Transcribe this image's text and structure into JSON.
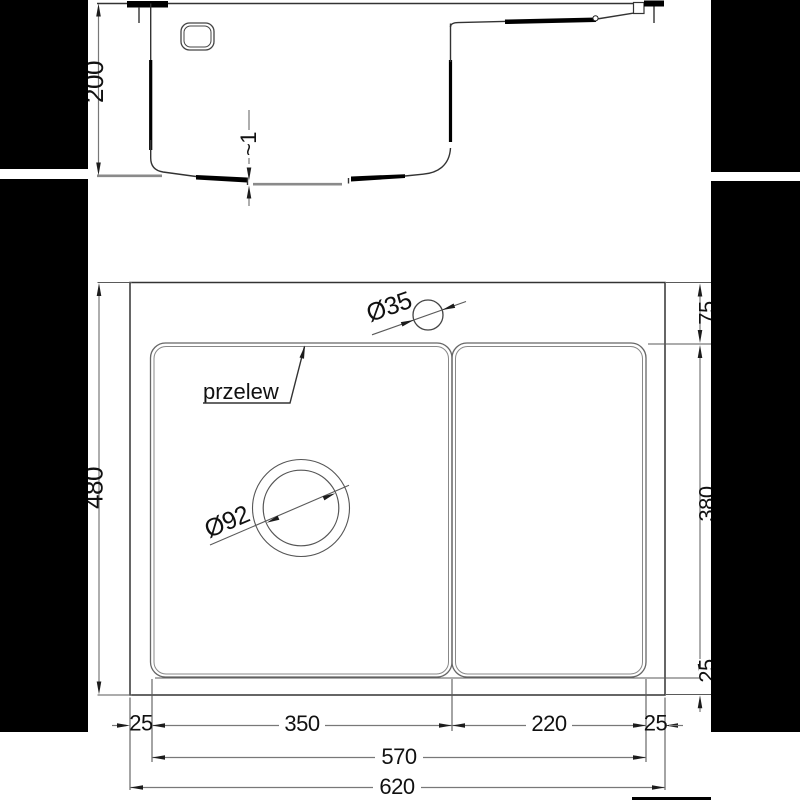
{
  "drawing": {
    "type": "sink-technical-drawing",
    "section_view": {
      "depth_dim": "200",
      "bottom_step_dim": "~1"
    },
    "plan_view": {
      "overflow_label": "przelew",
      "faucet_hole_dim": "Ø35",
      "drain_hole_dim": "Ø92",
      "overall_height_dim": "480",
      "top_margin_dim": "75",
      "bowl_height_dim": "380",
      "bottom_margin_dim": "25",
      "bottom_dims": {
        "left_margin": "25",
        "bowl_width": "350",
        "drainboard_width": "220",
        "right_margin": "25",
        "inner_width": "570",
        "overall_width": "620"
      }
    },
    "colors": {
      "line": "#333333",
      "thick_line": "#000000",
      "dim_line": "#787878",
      "background": "#ffffff",
      "mask": "#000000"
    }
  }
}
